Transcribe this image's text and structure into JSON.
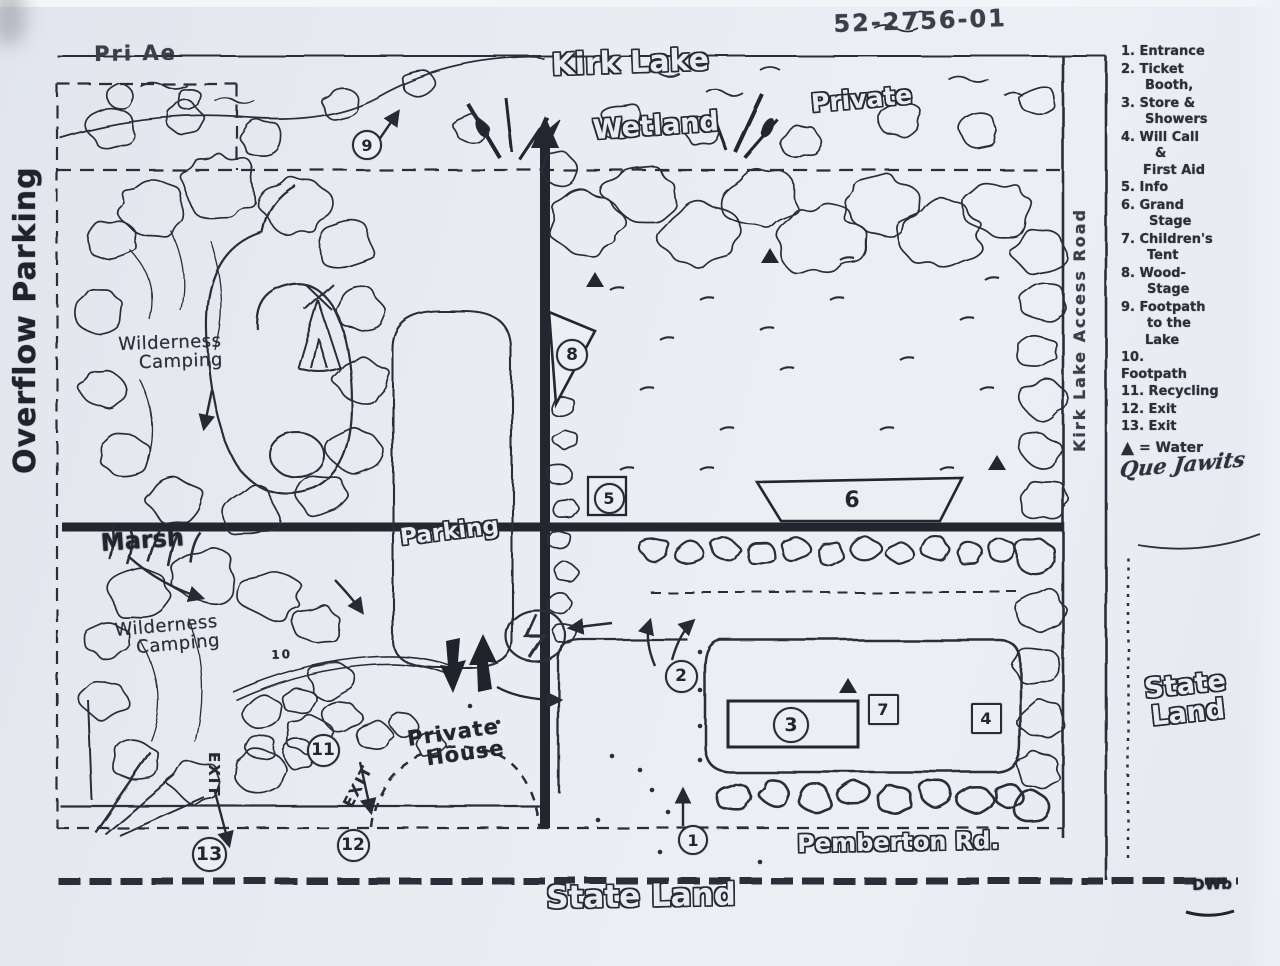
{
  "ref_number": "52-2756-01",
  "legend": {
    "items": [
      {
        "name": "entrance",
        "lines": [
          {
            "t": "1. Entrance",
            "i": 0
          }
        ]
      },
      {
        "name": "ticket-booth",
        "lines": [
          {
            "t": "2. Ticket",
            "i": 0
          },
          {
            "t": "Booth,",
            "i": 24
          }
        ]
      },
      {
        "name": "store-showers",
        "lines": [
          {
            "t": "3. Store &",
            "i": 0
          },
          {
            "t": "Showers",
            "i": 24
          }
        ]
      },
      {
        "name": "will-call-first-aid",
        "lines": [
          {
            "t": "4. Will Call",
            "i": 0
          },
          {
            "t": "&",
            "i": 34
          },
          {
            "t": "First Aid",
            "i": 22
          }
        ]
      },
      {
        "name": "info",
        "lines": [
          {
            "t": "5. Info",
            "i": 0
          }
        ]
      },
      {
        "name": "grand-stage",
        "lines": [
          {
            "t": "6. Grand",
            "i": 0
          },
          {
            "t": "Stage",
            "i": 28
          }
        ]
      },
      {
        "name": "childrens-tent",
        "lines": [
          {
            "t": "7. Children's",
            "i": 0
          },
          {
            "t": "Tent",
            "i": 26
          }
        ]
      },
      {
        "name": "wood-stage",
        "lines": [
          {
            "t": "8. Wood-",
            "i": 0
          },
          {
            "t": "Stage",
            "i": 26
          }
        ]
      },
      {
        "name": "footpath-to-lake",
        "lines": [
          {
            "t": "9. Footpath",
            "i": 0
          },
          {
            "t": "to the",
            "i": 26
          },
          {
            "t": "Lake",
            "i": 24
          }
        ]
      },
      {
        "name": "footpath",
        "lines": [
          {
            "t": "10.",
            "i": 0
          },
          {
            "t": "Footpath",
            "i": 0
          }
        ]
      },
      {
        "name": "recycling",
        "lines": [
          {
            "t": "11. Recycling",
            "i": 0
          }
        ]
      },
      {
        "name": "exit-12",
        "lines": [
          {
            "t": "12. Exit",
            "i": 0
          }
        ]
      },
      {
        "name": "exit-13",
        "lines": [
          {
            "t": "13. Exit",
            "i": 0
          }
        ]
      }
    ],
    "water_note": {
      "symbol": "▲",
      "text": " = Water"
    },
    "signature": "Que Jawits"
  },
  "labels": [
    {
      "id": "ref-number",
      "text": "52-2756-01",
      "x": 833,
      "y": 12,
      "size": 24,
      "rot": -2,
      "kind": "hand"
    },
    {
      "id": "kirk-lake",
      "text": "Kirk Lake",
      "x": 551,
      "y": 50,
      "size": 30,
      "rot": -2,
      "kind": "bubble"
    },
    {
      "id": "wetland",
      "text": "Wetland",
      "x": 592,
      "y": 117,
      "size": 27,
      "rot": -4,
      "kind": "bubble"
    },
    {
      "id": "private-north",
      "text": "Private",
      "x": 810,
      "y": 91,
      "size": 25,
      "rot": -5,
      "kind": "bubble"
    },
    {
      "id": "private-partial",
      "text": "Pri Ae",
      "x": 94,
      "y": 44,
      "size": 21,
      "rot": -1,
      "kind": "hand"
    },
    {
      "id": "overflow-parking",
      "text": "Overflow Parking",
      "x": 10,
      "y": 474,
      "size": 30,
      "rot": -90,
      "kind": "dark"
    },
    {
      "id": "wilderness-camping-north",
      "text": "Wilderness\nCamping",
      "x": 118,
      "y": 336,
      "size": 18,
      "rot": -2,
      "kind": "script",
      "ind": [
        0,
        20
      ]
    },
    {
      "id": "marsh",
      "text": "Marsh",
      "x": 100,
      "y": 531,
      "size": 24,
      "rot": -4,
      "kind": "heavy"
    },
    {
      "id": "wilderness-camping-south",
      "text": "Wilderness\nCamping",
      "x": 114,
      "y": 622,
      "size": 18,
      "rot": -5,
      "kind": "script",
      "ind": [
        0,
        20
      ]
    },
    {
      "id": "parking",
      "text": "Parking",
      "x": 399,
      "y": 527,
      "size": 23,
      "rot": -7,
      "kind": "bubble"
    },
    {
      "id": "footpath-10-label",
      "text": "10",
      "x": 271,
      "y": 649,
      "size": 12,
      "rot": -3,
      "kind": "darksm"
    },
    {
      "id": "exit-west",
      "text": "EXIT",
      "x": 221,
      "y": 752,
      "size": 15,
      "rot": 90,
      "kind": "darksm"
    },
    {
      "id": "exit-mid",
      "text": "EXIT",
      "x": 341,
      "y": 803,
      "size": 15,
      "rot": -62,
      "kind": "darksm"
    },
    {
      "id": "private-house",
      "text": "Private\nHouse",
      "x": 406,
      "y": 729,
      "size": 21,
      "rot": -8,
      "kind": "marker",
      "ind": [
        0,
        16
      ]
    },
    {
      "id": "pemberton-rd",
      "text": "Pemberton Rd.",
      "x": 797,
      "y": 832,
      "size": 24,
      "rot": -1,
      "kind": "bubble"
    },
    {
      "id": "state-land-south",
      "text": "State Land",
      "x": 546,
      "y": 882,
      "size": 31,
      "rot": -1,
      "kind": "bubble"
    },
    {
      "id": "state-land-east",
      "text": "State\nLand",
      "x": 1143,
      "y": 676,
      "size": 27,
      "rot": -6,
      "kind": "bubble",
      "ind": [
        0,
        4
      ]
    },
    {
      "id": "access-road",
      "text": "Kirk Lake Access Road",
      "x": 1072,
      "y": 452,
      "size": 16,
      "rot": -90,
      "kind": "hand"
    },
    {
      "id": "artist-mark",
      "text": "DWb",
      "x": 1192,
      "y": 878,
      "size": 15,
      "rot": -2,
      "kind": "heavy"
    }
  ],
  "markers": [
    {
      "n": "9",
      "shape": "circle",
      "x": 365,
      "y": 143,
      "d": 26
    },
    {
      "n": "8",
      "shape": "circle",
      "x": 570,
      "y": 353,
      "d": 28
    },
    {
      "n": "5",
      "shape": "circle",
      "x": 607,
      "y": 496,
      "d": 27
    },
    {
      "n": "6",
      "shape": "plain",
      "x": 852,
      "y": 500,
      "d": 30
    },
    {
      "n": "2",
      "shape": "circle",
      "x": 679,
      "y": 674,
      "d": 29
    },
    {
      "n": "3",
      "shape": "circle",
      "x": 789,
      "y": 723,
      "d": 32
    },
    {
      "n": "7",
      "shape": "square",
      "x": 881,
      "y": 707,
      "d": 27
    },
    {
      "n": "4",
      "shape": "square",
      "x": 984,
      "y": 716,
      "d": 27
    },
    {
      "n": "1",
      "shape": "circle",
      "x": 691,
      "y": 838,
      "d": 26
    },
    {
      "n": "11",
      "shape": "circle",
      "x": 321,
      "y": 748,
      "d": 29
    },
    {
      "n": "12",
      "shape": "circle",
      "x": 351,
      "y": 843,
      "d": 29
    },
    {
      "n": "13",
      "shape": "circle",
      "x": 207,
      "y": 852,
      "d": 31
    }
  ],
  "water_symbols": [
    {
      "x": 595,
      "y": 283
    },
    {
      "x": 770,
      "y": 259
    },
    {
      "x": 997,
      "y": 466
    },
    {
      "x": 848,
      "y": 689
    }
  ]
}
